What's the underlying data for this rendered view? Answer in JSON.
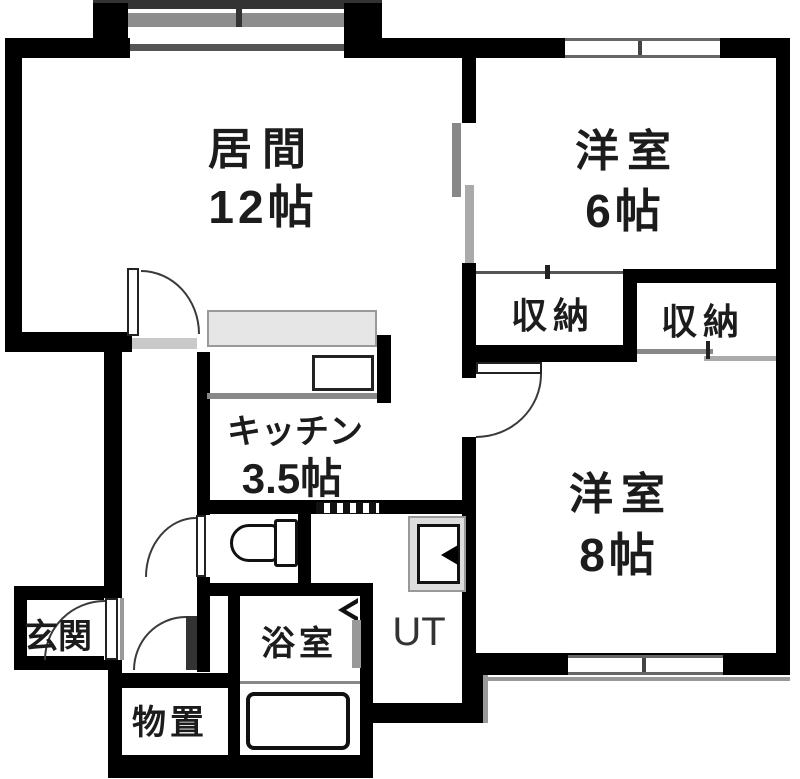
{
  "rooms": {
    "living": {
      "name": "居間",
      "size": "12帖"
    },
    "western6": {
      "name": "洋室",
      "size": "6帖"
    },
    "western8": {
      "name": "洋室",
      "size": "8帖"
    },
    "kitchen": {
      "name": "キッチン",
      "size": "3.5帖"
    },
    "closet_left": {
      "name": "収納"
    },
    "closet_right": {
      "name": "収納"
    },
    "utility": {
      "name": "UT"
    },
    "bath": {
      "name": "浴室"
    },
    "storage": {
      "name": "物置"
    },
    "entrance": {
      "name": "玄関"
    }
  },
  "colors": {
    "wall": "#000000",
    "counter": "#e6e6e6",
    "window_frame": "#777777",
    "sliding_door": "#999999",
    "fixture_outline": "#111111",
    "text": "#1c1c1c"
  }
}
